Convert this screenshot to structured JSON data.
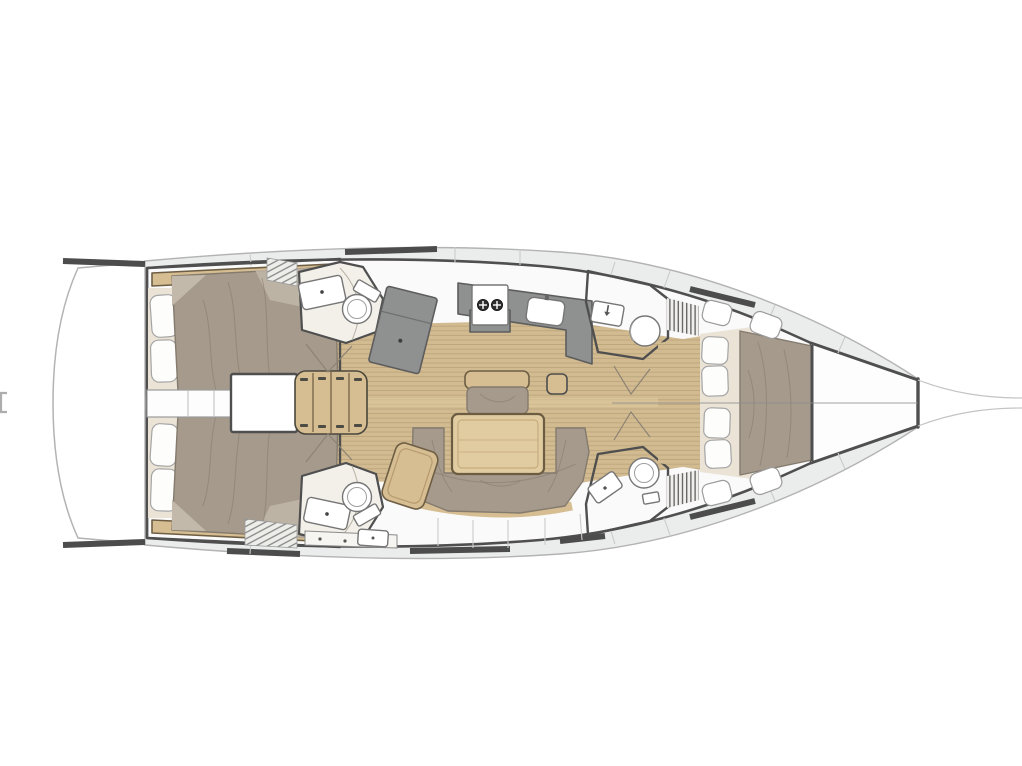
{
  "diagram": {
    "type": "yacht-deck-floor-plan",
    "orientation": "bow-right",
    "regions": [
      "swim-platform",
      "aft-cabin-port",
      "aft-cabin-starboard",
      "engine-corridor",
      "engine-compartment",
      "companionway-stairs",
      "aft-head-port",
      "aft-head-starboard",
      "nav-station-desk",
      "galley",
      "stove",
      "galley-sink",
      "mast-step",
      "salon-bench",
      "salon-table",
      "salon-sofa",
      "chaise-seat",
      "forward-head-port",
      "forward-head-starboard",
      "shower-grate-port",
      "shower-grate-starboard",
      "locker-vent-port",
      "locker-vent-starboard",
      "forward-cabin",
      "anchor-locker",
      "bowsprit"
    ]
  },
  "colors": {
    "background": "#ffffff",
    "deck": "#ebecec",
    "deck-seam": "#cbcbcb",
    "hull-stroke": "#b3b3b3",
    "wall": "#4f4f4f",
    "interior": "#fafafa",
    "room-cream": "#f3f0ea",
    "wood": "#d2bb91",
    "wood-line": "#bba37a",
    "wood-light": "#dfcb9e",
    "furn-tan": "#d6bd92",
    "furn-tan-stroke": "#6e5f44",
    "table-wood": "#e1cba1",
    "mattress": "#a59a8c",
    "mattress-dark": "#857a6d",
    "mattress-light": "#c3b9aa",
    "cream": "#eae3d6",
    "pillow": "#fdfdfc",
    "pillow-stroke": "#a5a5a5",
    "counter": "#8f9090",
    "counter-stroke": "#5d5d5d",
    "fixture": "#ffffff",
    "fixture-stroke": "#767676",
    "rail": "#4c4c4c",
    "swing": "#8d8373",
    "bowsprit": "#c4c4c4",
    "burner": "#2e2e2e"
  }
}
